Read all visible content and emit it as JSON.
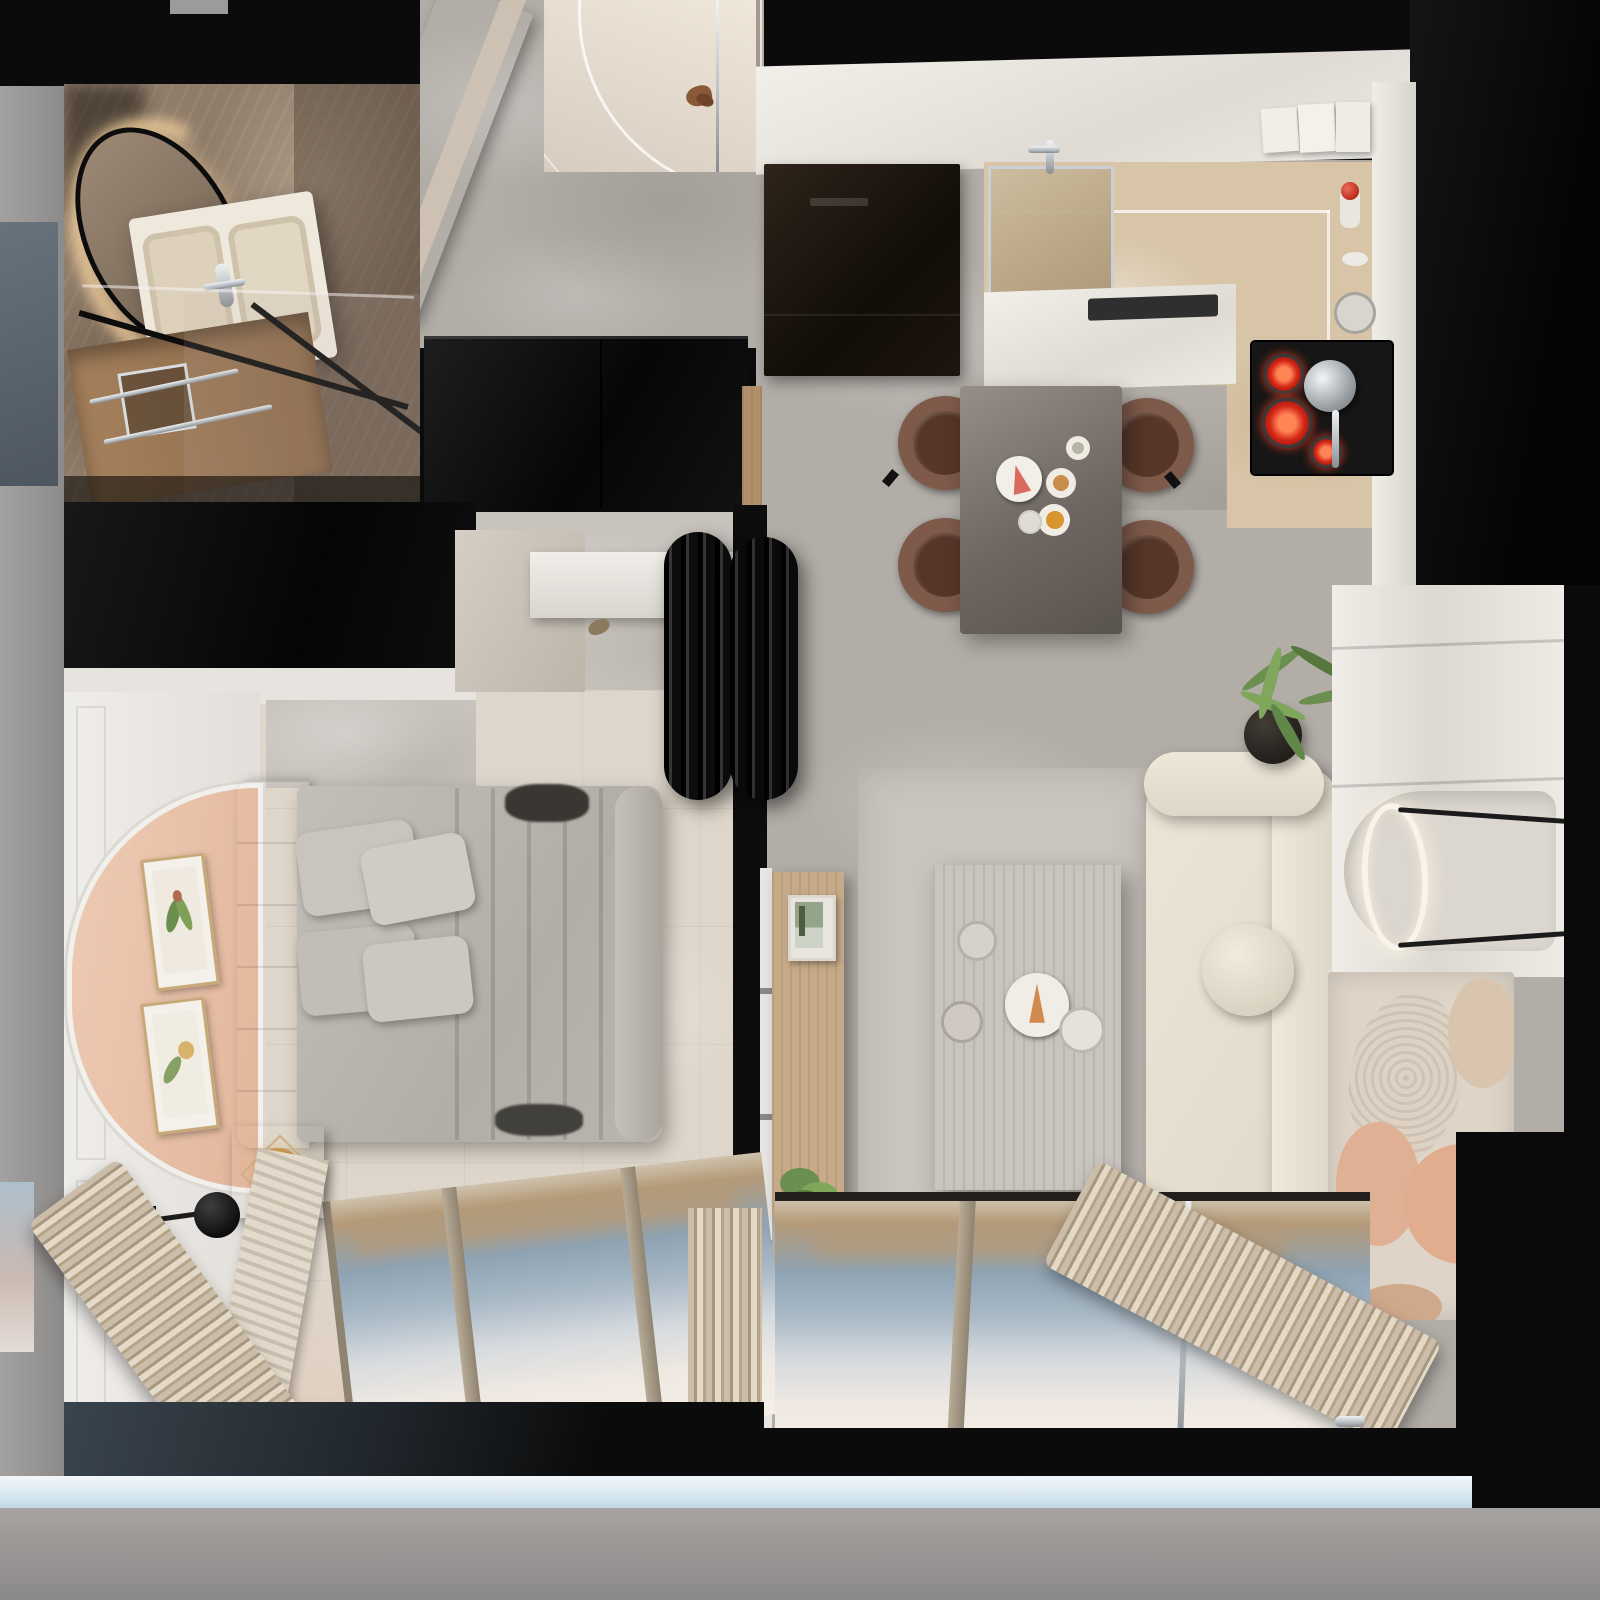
{
  "scene": {
    "type": "apartment-top-down-render",
    "description": "Photorealistic top-down 3D render of a small apartment: bathroom (top-left), entry hall and wardrobe (center-top), kitchen with dining area (right-top), bedroom (left-bottom), living room with media wall (right-bottom), floor-to-ceiling balcony windows with sea view along the bottom.",
    "rooms": [
      {
        "name": "bathroom",
        "items": [
          "organic-mirror",
          "double-sink-vanity",
          "shower-glass",
          "towel-rails",
          "wood-vanity-cabinet"
        ]
      },
      {
        "name": "entry-hall",
        "items": [
          "entry-door",
          "wood-slat-partition",
          "wardrobe",
          "slippers"
        ]
      },
      {
        "name": "kitchen",
        "items": [
          "refrigerator",
          "kitchen-sink",
          "countertops",
          "cooktop",
          "kettle",
          "countertop-appliances",
          "fire-extinguisher",
          "pots"
        ]
      },
      {
        "name": "dining-area",
        "items": [
          "dining-table",
          "dining-chairs-x4",
          "dessert-plates",
          "coffee-cups"
        ]
      },
      {
        "name": "bedroom",
        "items": [
          "double-bed",
          "pillows-x4",
          "fur-throw",
          "tufted-headboard",
          "arched-pink-wall-panel",
          "framed-botanical-prints-x2",
          "nightstand",
          "gold-bowl",
          "wall-sconce",
          "wall-shelf",
          "window",
          "curtains"
        ]
      },
      {
        "name": "living-room",
        "items": [
          "cream-sofa",
          "round-bolster-cushion",
          "coffee-table",
          "wood-media-console",
          "framed-photo",
          "potted-plants-x2",
          "area-rug",
          "abstract-patterned-rug",
          "fluted-black-partition",
          "media-wall",
          "oval-led-wall-lamp",
          "window",
          "curtains"
        ]
      },
      {
        "name": "balcony-exterior",
        "items": [
          "glass-railing",
          "sea-view-reflection"
        ]
      }
    ],
    "labels": {
      "mirror": "organic wall mirror with LED backlight",
      "vanity": "double-sink vanity",
      "shower": "glass shower screen",
      "towel_rail": "chrome towel rails",
      "wardrobe": "black gloss entry wardrobe",
      "entry_door": "entry door with swing arc",
      "beam": "wood slat partition",
      "shoes": "slippers",
      "refrigerator": "built-in dark refrigerator",
      "sink": "kitchen sink with chrome frame",
      "counter": "white kitchen countertop",
      "cooktop": "cooktop with red-hot burners",
      "kettle": "chrome kettle",
      "appliances": "countertop appliances",
      "extinguisher": "fire extinguisher",
      "dining_table": "bronze dining table for four",
      "dining_chair": "brown leather dining chair",
      "cake_plate": "plate with pink cake slice",
      "bed": "double bed with gray duvet",
      "headboard": "tufted headboard",
      "pillow": "gray pillow",
      "fur_throw": "dark fur throw",
      "pink_panel": "arched peach wall panel",
      "prints": "framed botanical print",
      "nightstand": "bedside table",
      "gold_bowl": "gold decorative bowl",
      "sconce": "black ball wall sconce",
      "shelf": "white wall shelf",
      "columns": "fluted black glass partition",
      "console": "wood media console",
      "photo": "framed landscape photo",
      "plant": "potted green plant",
      "sofa": "cream three-seat sofa",
      "round_cushion": "round bolster cushion",
      "coffee_table": "dark wood coffee table",
      "rug": "living room area rug",
      "pattern_rug": "abstract rug with peach shapes",
      "media_wall": "glossy white media wall",
      "oval_lamp": "oval LED wall lamp",
      "window": "floor-to-ceiling window",
      "curtain": "gathered curtains",
      "balcony": "balcony glazing",
      "water_view": "sea view reflection"
    },
    "palette": {
      "wall-black": "#0b0b0b",
      "marble-floor": "#b2ada7",
      "marble-light": "#c8c3bd",
      "bedroom-floor": "#ded6ca",
      "kitchen-tile": "#d8c5a7",
      "entry-floor": "#e8ddd2",
      "bath-marble": "#8f7c69",
      "wood": "#b2906c",
      "white-wall": "#ebe8e3",
      "pink-panel": "#e9c2a9",
      "sofa-cream": "#e9e2d3",
      "bed-gray": "#b5b1ac",
      "pillow-gray": "#c6c1ba",
      "fur-dark": "#3a3733",
      "chair-brown": "#7d5a4a",
      "table-bronze": "#6e6761",
      "coffee-table": "#463e37",
      "plant-green": "#6a8f4e",
      "red-burner": "#d42716",
      "gold": "#c18a41",
      "water-view": "#8fa3b3",
      "shore-tan": "#b59a78",
      "glass-blue": "#cfe2ed",
      "exterior-gray": "#8e8e8e",
      "curtain-beige": "#cbbda9",
      "curtain-shadow": "#a69781",
      "rug-pattern": "#ded4c8",
      "rug-peach": "#dfb094",
      "led-warm": "#eac89a"
    }
  }
}
